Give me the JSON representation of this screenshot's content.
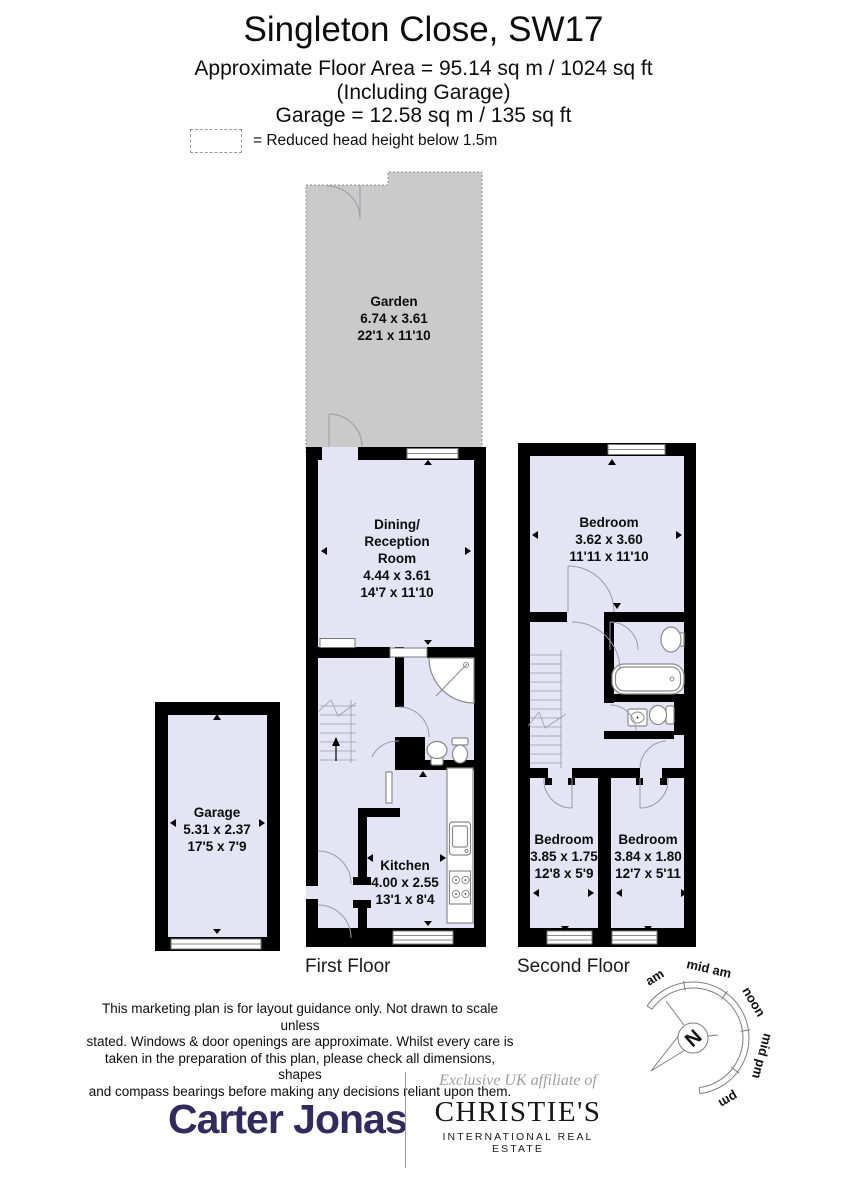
{
  "header": {
    "title": "Singleton Close, SW17",
    "area_line": "Approximate Floor Area = 95.14 sq m / 1024 sq ft",
    "including_line": "(Including Garage)",
    "garage_line": "Garage = 12.58 sq m / 135 sq ft"
  },
  "legend": {
    "label": "= Reduced head height below 1.5m"
  },
  "rooms": {
    "garden": {
      "name": "Garden",
      "metric": "6.74 x 3.61",
      "imperial": "22'1 x 11'10"
    },
    "dining": {
      "name_lines": [
        "Dining/",
        "Reception",
        "Room"
      ],
      "metric": "4.44 x 3.61",
      "imperial": "14'7 x 11'10"
    },
    "kitchen": {
      "name": "Kitchen",
      "metric": "4.00 x 2.55",
      "imperial": "13'1 x 8'4"
    },
    "garage": {
      "name": "Garage",
      "metric": "5.31 x 2.37",
      "imperial": "17'5 x 7'9"
    },
    "bedroom1": {
      "name": "Bedroom",
      "metric": "3.62 x 3.60",
      "imperial": "11'11 x 11'10"
    },
    "bedroom2": {
      "name": "Bedroom",
      "metric": "3.85 x 1.75",
      "imperial": "12'8 x 5'9"
    },
    "bedroom3": {
      "name": "Bedroom",
      "metric": "3.84 x 1.80",
      "imperial": "12'7 x 5'11"
    }
  },
  "floors": {
    "first": "First Floor",
    "second": "Second Floor"
  },
  "disclaimer": {
    "lines": [
      "This marketing plan is for layout guidance only. Not drawn to scale unless",
      "stated. Windows & door openings are approximate. Whilst every care is",
      "taken in the preparation of this plan,  please check all dimensions, shapes",
      "and compass bearings before making any decisions reliant upon them."
    ]
  },
  "compass": {
    "labels": [
      "am",
      "mid am",
      "noon",
      "mid pm",
      "pm"
    ],
    "north": "N"
  },
  "footer": {
    "carter_jonas": "Carter Jonas",
    "affiliate": "Exclusive UK affiliate of",
    "christies": "CHRISTIE'S",
    "christies_sub": "INTERNATIONAL REAL ESTATE"
  },
  "colors": {
    "wall": "#000000",
    "room": "#e4e4f5",
    "garden": "#cacaca",
    "navy": "#312b5e",
    "gray-affil": "#9d9da2"
  }
}
